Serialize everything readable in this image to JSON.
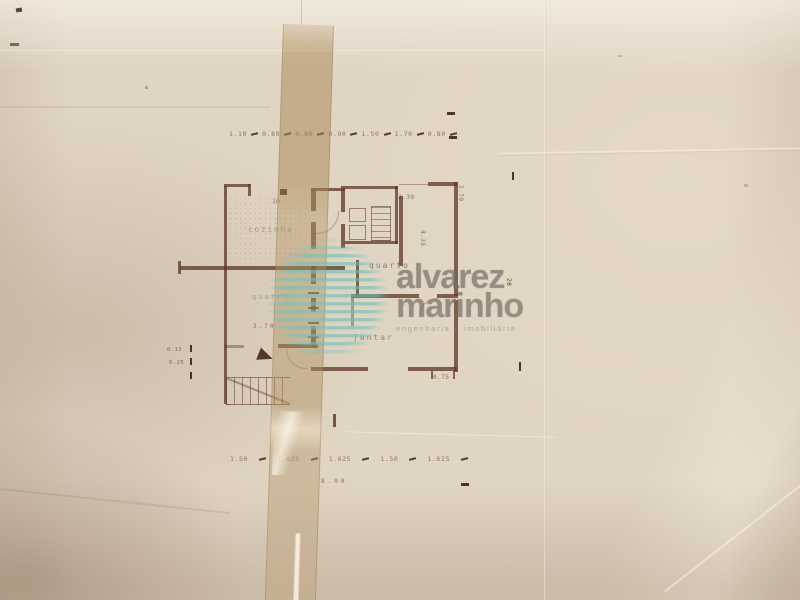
{
  "watermark": {
    "line1": "alvarez",
    "line2": "marinho",
    "tagline": "engenharia e imobiliária"
  },
  "plan": {
    "rooms": [
      {
        "label": "cozinha"
      },
      {
        "label": "quarto"
      },
      {
        "label": "quarto"
      },
      {
        "label": "jantar"
      }
    ],
    "dims": {
      "top": [
        "1.10",
        "0.80",
        "0.80",
        "0.90",
        "1.50",
        "1.70",
        "0.80"
      ],
      "bottom": [
        "1.50",
        "1.625",
        "1.625",
        "1.50",
        "1.625"
      ],
      "bottom_total": "8.00",
      "top_right_width": "2.30",
      "right_height": "2.70",
      "hall_height": "4.35",
      "bottom_right": "0.75",
      "left_width": "3.70",
      "kitchen_note": "1m",
      "side_note": "20",
      "left_ticks": [
        "0.15",
        "0.25"
      ]
    }
  },
  "colors": {
    "paper": "#e0d4c3",
    "ink": "#5e3526",
    "tape": "#b99a67",
    "watermark_text": "#767068",
    "watermark_stripes": "#6fc2b8"
  }
}
